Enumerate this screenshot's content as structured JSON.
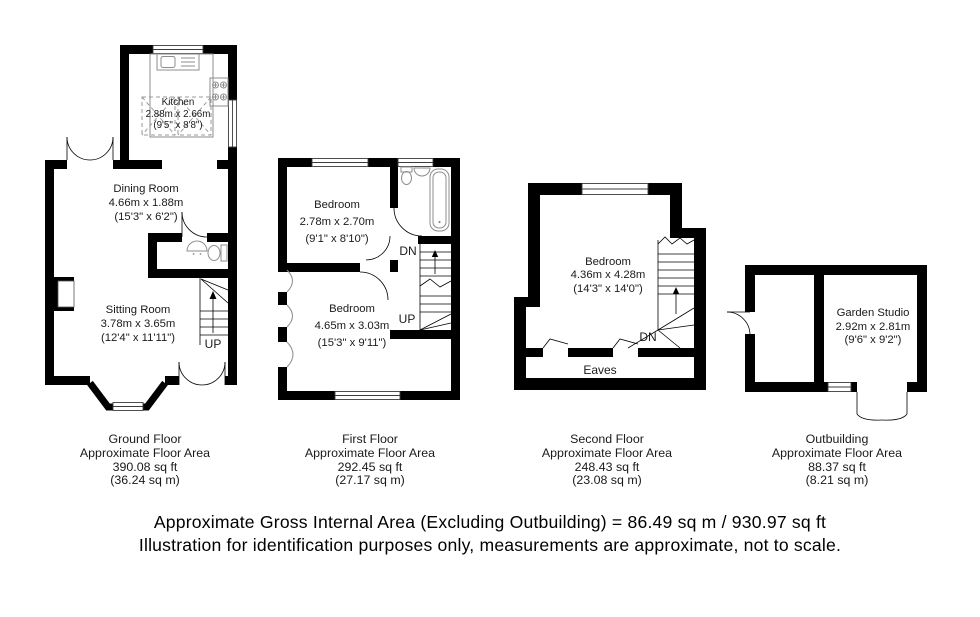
{
  "page": {
    "background": "#ffffff",
    "wall_color": "#000000"
  },
  "floors": [
    {
      "name": "Ground Floor",
      "area_label": "Approximate Floor Area",
      "area_sqft": "390.08 sq ft",
      "area_sqm": "(36.24 sq m)",
      "rooms": [
        {
          "name": "Kitchen",
          "dims_m": "2.88m x 2.66m",
          "dims_ft": "(9'5\" x 8'8\")"
        },
        {
          "name": "Dining Room",
          "dims_m": "4.66m x 1.88m",
          "dims_ft": "(15'3\" x 6'2\")"
        },
        {
          "name": "Sitting Room",
          "dims_m": "3.78m x 3.65m",
          "dims_ft": "(12'4\" x 11'11\")"
        }
      ],
      "labels": {
        "up": "UP"
      }
    },
    {
      "name": "First Floor",
      "area_label": "Approximate Floor Area",
      "area_sqft": "292.45 sq ft",
      "area_sqm": "(27.17 sq m)",
      "rooms": [
        {
          "name": "Bedroom",
          "dims_m": "2.78m x 2.70m",
          "dims_ft": "(9'1\" x 8'10\")"
        },
        {
          "name": "Bedroom",
          "dims_m": "4.65m x 3.03m",
          "dims_ft": "(15'3\" x 9'11\")"
        }
      ],
      "labels": {
        "up": "UP",
        "dn": "DN"
      }
    },
    {
      "name": "Second Floor",
      "area_label": "Approximate Floor Area",
      "area_sqft": "248.43 sq ft",
      "area_sqm": "(23.08 sq m)",
      "rooms": [
        {
          "name": "Bedroom",
          "dims_m": "4.36m x 4.28m",
          "dims_ft": "(14'3\" x 14'0\")"
        }
      ],
      "labels": {
        "dn": "DN",
        "eaves": "Eaves"
      }
    },
    {
      "name": "Outbuilding",
      "area_label": "Approximate Floor Area",
      "area_sqft": "88.37 sq ft",
      "area_sqm": "(8.21 sq m)",
      "rooms": [
        {
          "name": "Garden Studio",
          "dims_m": "2.92m x 2.81m",
          "dims_ft": "(9'6\" x 9'2\")"
        }
      ],
      "labels": {}
    }
  ],
  "footer": {
    "line1": "Approximate Gross Internal Area (Excluding Outbuilding) = 86.49 sq m / 930.97 sq ft",
    "line2": "Illustration for identification purposes only, measurements are approximate, not to scale."
  }
}
